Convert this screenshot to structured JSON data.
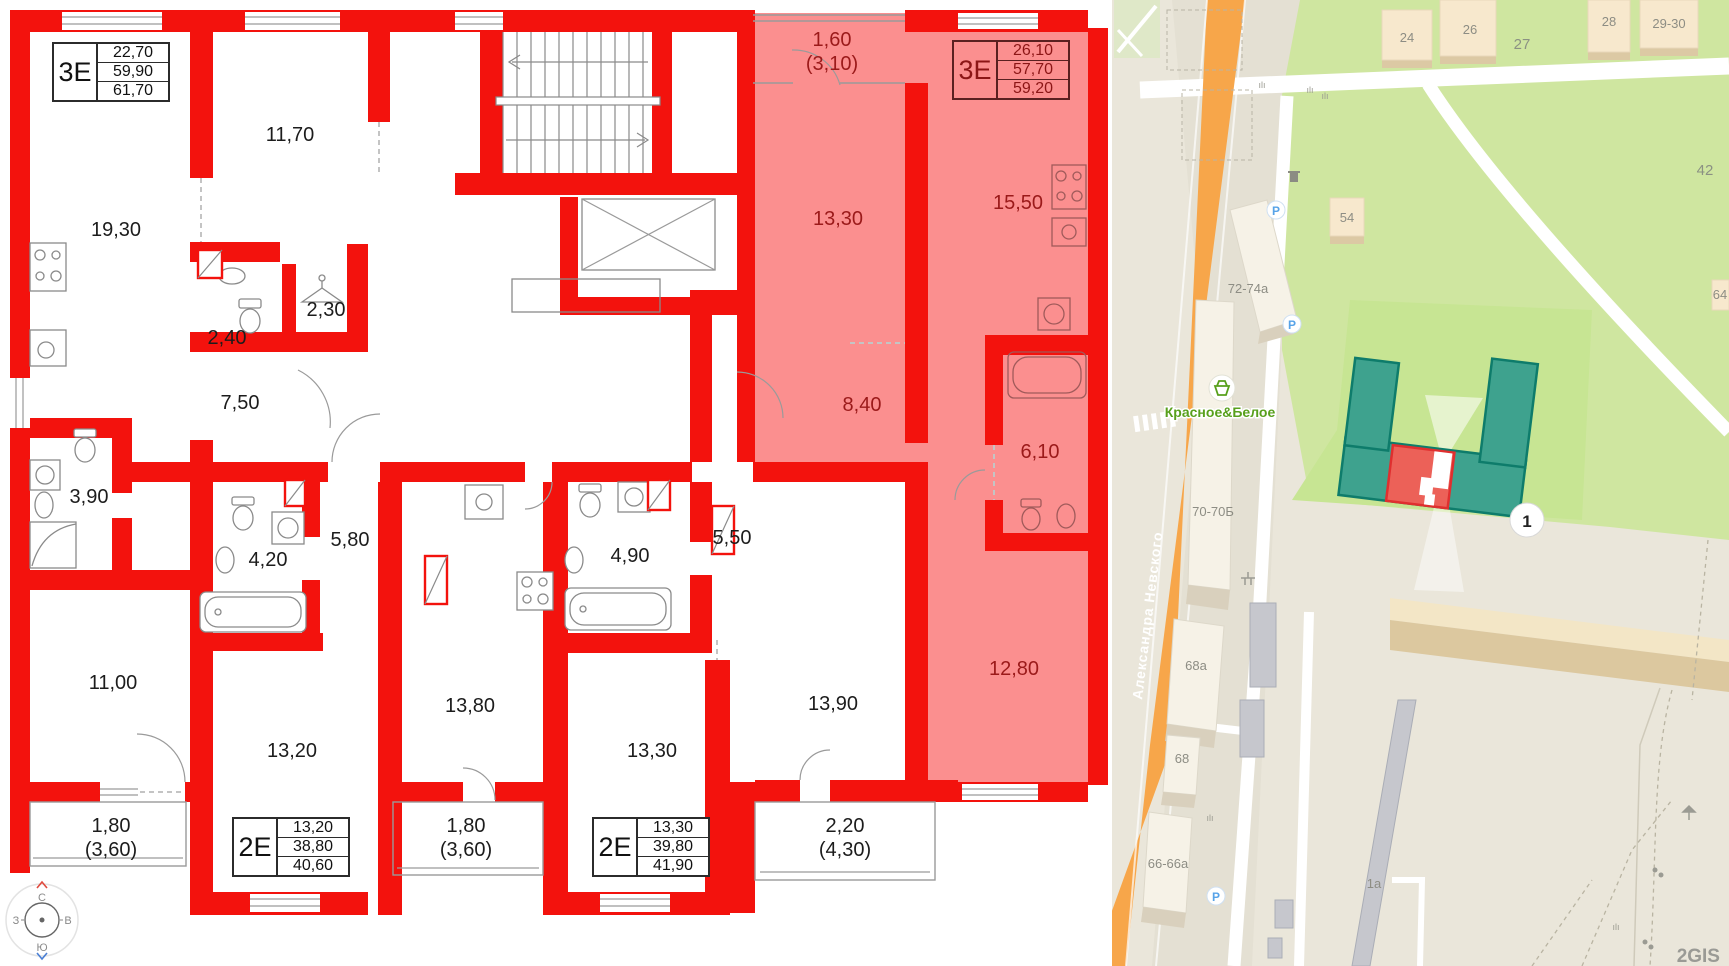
{
  "plan": {
    "tables": [
      {
        "type": "3Е",
        "values": [
          "22,70",
          "59,90",
          "61,70"
        ]
      },
      {
        "type": "3Е",
        "values": [
          "26,10",
          "57,70",
          "59,20"
        ]
      },
      {
        "type": "2Е",
        "values": [
          "13,20",
          "38,80",
          "40,60"
        ]
      },
      {
        "type": "2Е",
        "values": [
          "13,30",
          "39,80",
          "41,90"
        ]
      }
    ],
    "rooms": {
      "r19_30": "19,30",
      "r11_70": "11,70",
      "r2_40": "2,40",
      "r2_30": "2,30",
      "r7_50": "7,50",
      "r3_90": "3,90",
      "r11_00": "11,00",
      "r4_20": "4,20",
      "r5_80": "5,80",
      "r13_20": "13,20",
      "r13_80": "13,80",
      "r4_90": "4,90",
      "r5_50": "5,50",
      "r13_30": "13,30",
      "r13_90": "13,90",
      "hl_13_30": "13,30",
      "hl_15_50": "15,50",
      "hl_8_40": "8,40",
      "hl_6_10": "6,10",
      "hl_12_80": "12,80"
    },
    "balconies": {
      "b1_line1": "1,60",
      "b1_line2": "(3,10)",
      "b2_line1": "1,80",
      "b2_line2": "(3,60)",
      "b3_line1": "1,80",
      "b3_line2": "(3,60)",
      "b4_line1": "2,20",
      "b4_line2": "(4,30)"
    },
    "compass": {
      "n": "С",
      "e": "В",
      "s": "Ю",
      "w": "З"
    }
  },
  "map": {
    "street_name": "Александра Невского",
    "store_label": "Красное&Белое",
    "marker_label": "1",
    "watermark": "2GIS",
    "parking_label": "P",
    "buildings": {
      "b24": "24",
      "b26": "26",
      "b27": "27",
      "b28": "28",
      "b29_30": "29-30",
      "b42": "42",
      "b54": "54",
      "b64": "64",
      "b72_74a": "72-74а",
      "b70_70b": "70-70Б",
      "b68a": "68а",
      "b68": "68",
      "b66_66a": "66-66а",
      "b1a": "1а"
    }
  },
  "colors": {
    "wall_red": "#f3120d",
    "highlight_fill": "#fb8f8f",
    "highlight_text": "#9b1a1a",
    "map_green": "#cfe6a0",
    "lawn_green": "#c7e593",
    "building_teal": "#3ea28e",
    "teal_stroke": "#0e7c6b",
    "selected_building_red": "#ec6158",
    "orange_road": "#f7a64a",
    "store_green": "#58a01c",
    "parking_blue": "#57a3e8"
  }
}
